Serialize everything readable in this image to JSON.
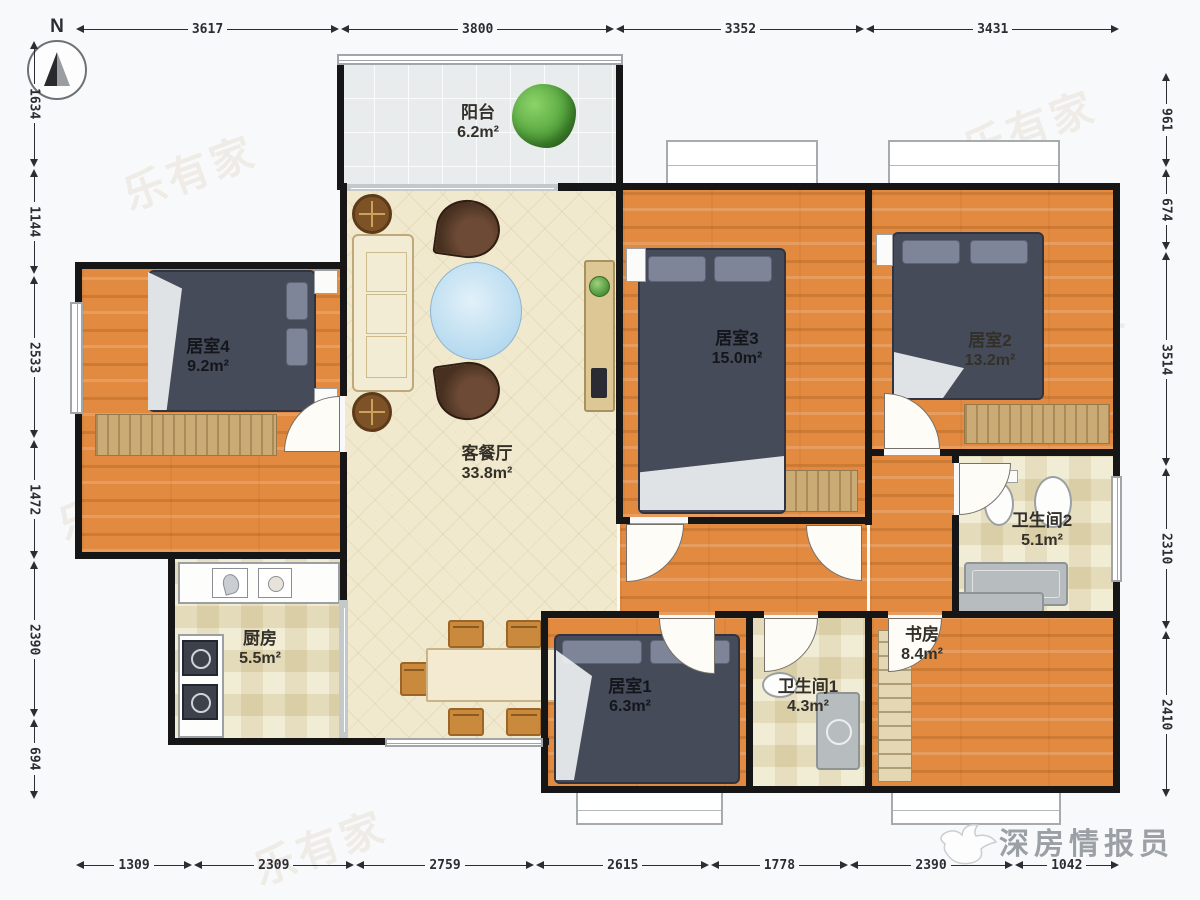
{
  "compass": {
    "label": "N"
  },
  "brand": {
    "name": "深房情报员"
  },
  "watermark": {
    "text": "乐有家"
  },
  "rooms": {
    "balcony": {
      "name": "阳台",
      "area": "6.2m²"
    },
    "living": {
      "name": "客餐厅",
      "area": "33.8m²"
    },
    "bedroom4": {
      "name": "居室4",
      "area": "9.2m²"
    },
    "bedroom3": {
      "name": "居室3",
      "area": "15.0m²"
    },
    "bedroom2": {
      "name": "居室2",
      "area": "13.2m²"
    },
    "bedroom1": {
      "name": "居室1",
      "area": "6.3m²"
    },
    "kitchen": {
      "name": "厨房",
      "area": "5.5m²"
    },
    "bath2": {
      "name": "卫生间2",
      "area": "5.1m²"
    },
    "bath1": {
      "name": "卫生间1",
      "area": "4.3m²"
    },
    "study": {
      "name": "书房",
      "area": "8.4m²"
    }
  },
  "dimensions": {
    "top": [
      "3617",
      "3800",
      "3352",
      "3431"
    ],
    "bottom": [
      "1309",
      "2309",
      "2759",
      "2615",
      "1778",
      "2390",
      "1042"
    ],
    "left": [
      "1634",
      "1144",
      "2533",
      "1472",
      "2390",
      "694"
    ],
    "right": [
      "961",
      "674",
      "3514",
      "2310",
      "2410"
    ]
  }
}
